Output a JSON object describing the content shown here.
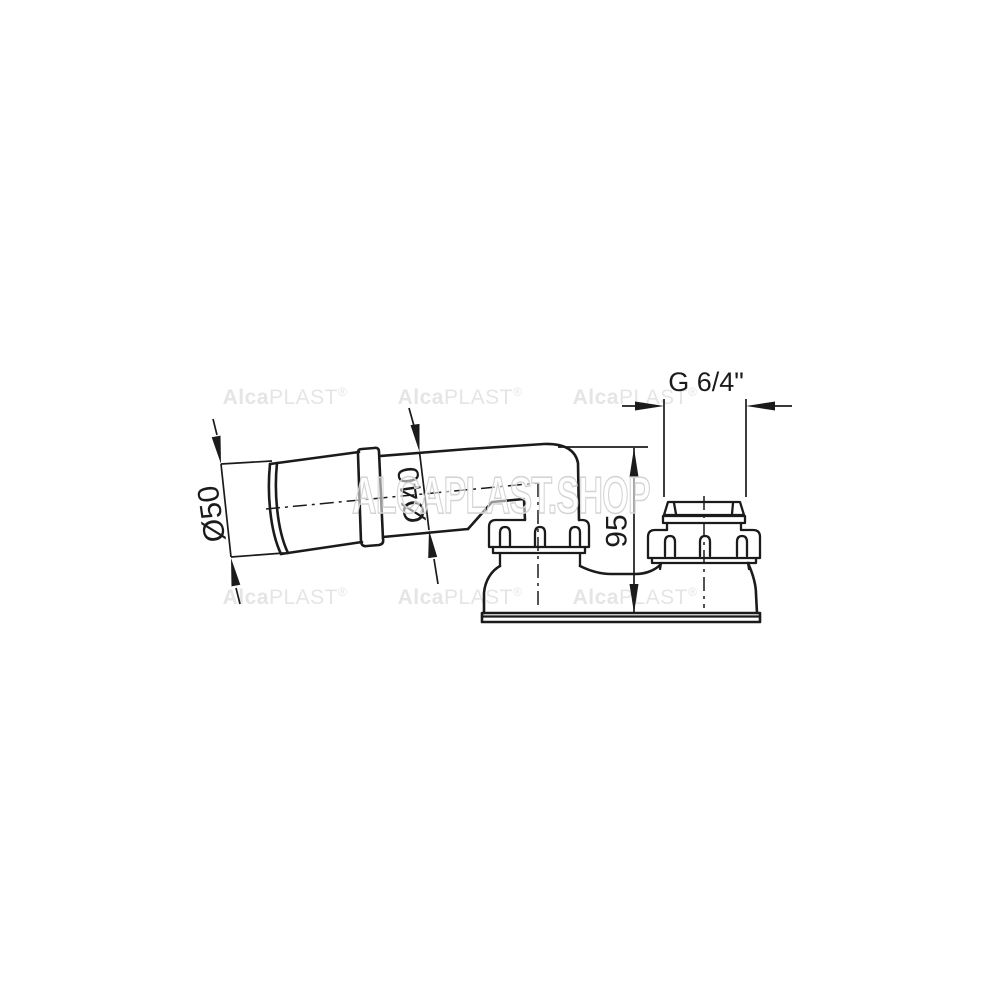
{
  "drawing": {
    "type": "technical-dimension-drawing",
    "subject": "siphon elbow fitting with two union nuts and base flange",
    "line_color": "#1b1b1b",
    "background": "#ffffff"
  },
  "dimensions": {
    "inlet_outer_diameter": "Ø50",
    "pipe_diameter": "Ø40",
    "height": "95",
    "thread_size": "G 6/4\""
  },
  "watermark": {
    "brand_bold": "Alca",
    "brand_light": "PLAST",
    "registered": "®",
    "shop": "ALCAPLAST.SHOP",
    "small_color": "#e5e5e5",
    "big_outline_color": "#d4d4d4"
  }
}
